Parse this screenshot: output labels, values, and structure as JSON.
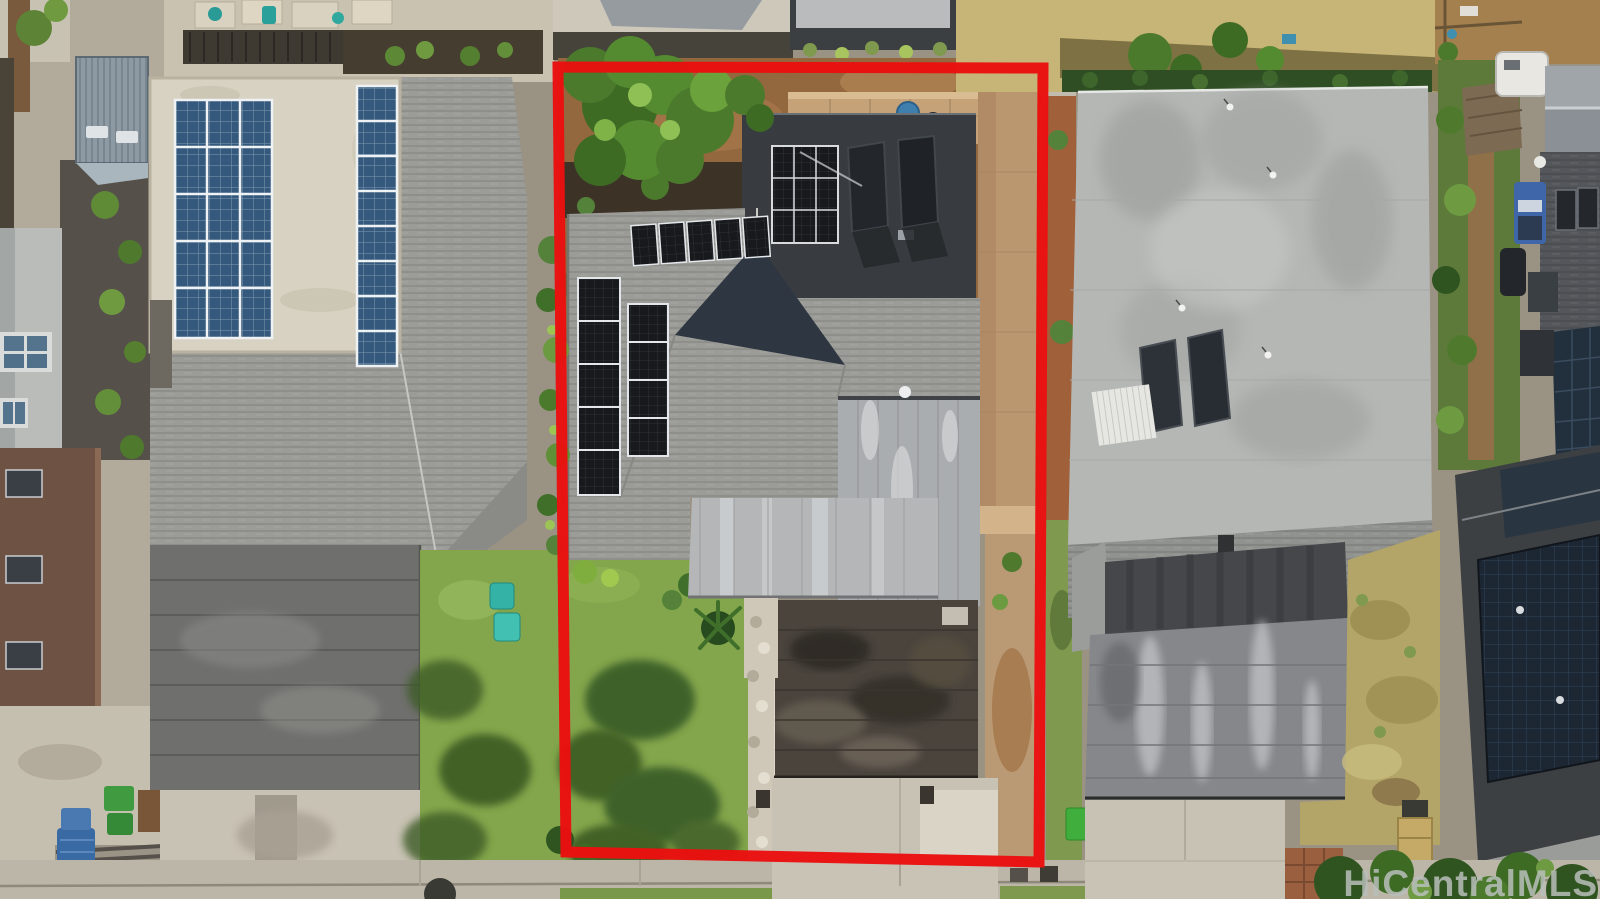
{
  "watermark": {
    "text": "HiCentralMLS"
  },
  "annotation": {
    "boundary_color": "#ea1010",
    "boundary_width_px": 11,
    "boundary_shape": "rectangle around center parcel"
  },
  "scene": {
    "type": "aerial-drone-photo",
    "description": "Top-down view of three residential lots; center lot outlined in red",
    "colors": {
      "ground_base": "#9a9283",
      "lawn": "#83a64c",
      "lawn_shadow": "#33511f",
      "dirt": "#93683f",
      "dried_grass": "#b3a567",
      "concrete": "#c8c2b4",
      "stone_walk": "#cfc8b8",
      "shingle_gray": "#9b9b97",
      "flat_roof_gray": "#b5b7b5",
      "metal_roof": "#aaadaf",
      "patio_roof": "#b4b6b8",
      "weathered_roof": "#4a443d",
      "rear_flat_roof": "#383c40",
      "garage_metal_left": "#6f6f6d",
      "garage_streaked_right": "#85878a",
      "white_roof": "#d8d2c2",
      "brown_roof": "#6e5243",
      "solar_blue": "#35597c",
      "solar_black": "#17191c",
      "solar_navy_field": "#1d2733",
      "stone_wall_tan": "#c5a278",
      "hedge_green": "#2f4e23",
      "tree_green": "#4c7a2c",
      "trash_bin_green": "#3fae3c",
      "lounge_teal": "#35b2a6",
      "trailer_white": "#e9e7e1",
      "shed_gray_blue": "#8d9aa3",
      "sidewalk": "#bcb6a8"
    },
    "parcels": [
      {
        "position": "left",
        "features": [
          "white flat roof with large blue solar array",
          "second blue solar strip",
          "gray shingle hip roof",
          "dark metal garage roof",
          "green lawn with two teal lawn chairs",
          "driveway",
          "corrugated shed",
          "brown flat roof building",
          "trash bins"
        ]
      },
      {
        "position": "center-outlined",
        "features": [
          "red boundary outline",
          "tree canopy over dirt backyard",
          "charcoal rear flat roof with black solar array and two solar water heaters",
          "gray shingle hip roof with black solar panel columns and ridge row",
          "standing-seam metal roof section",
          "light patio roof",
          "weathered dark garage roof",
          "stone walkway",
          "front lawn with tree shadows",
          "concrete driveway",
          "tan stone side wall"
        ]
      },
      {
        "position": "right",
        "features": [
          "hedge row",
          "large light-gray flat roof with bird specks",
          "two solar water heaters",
          "white corrugated patch",
          "shingle band",
          "streaked carport roof",
          "dried patchy lawn",
          "driveway",
          "green trash bin",
          "tan storage box"
        ]
      },
      {
        "position": "far-right-strip",
        "features": [
          "white trailer",
          "gable metal roof",
          "dark shingle roof",
          "navy solar roof planes",
          "side yard with vehicles and greenery",
          "trees at bottom corner"
        ]
      }
    ]
  }
}
